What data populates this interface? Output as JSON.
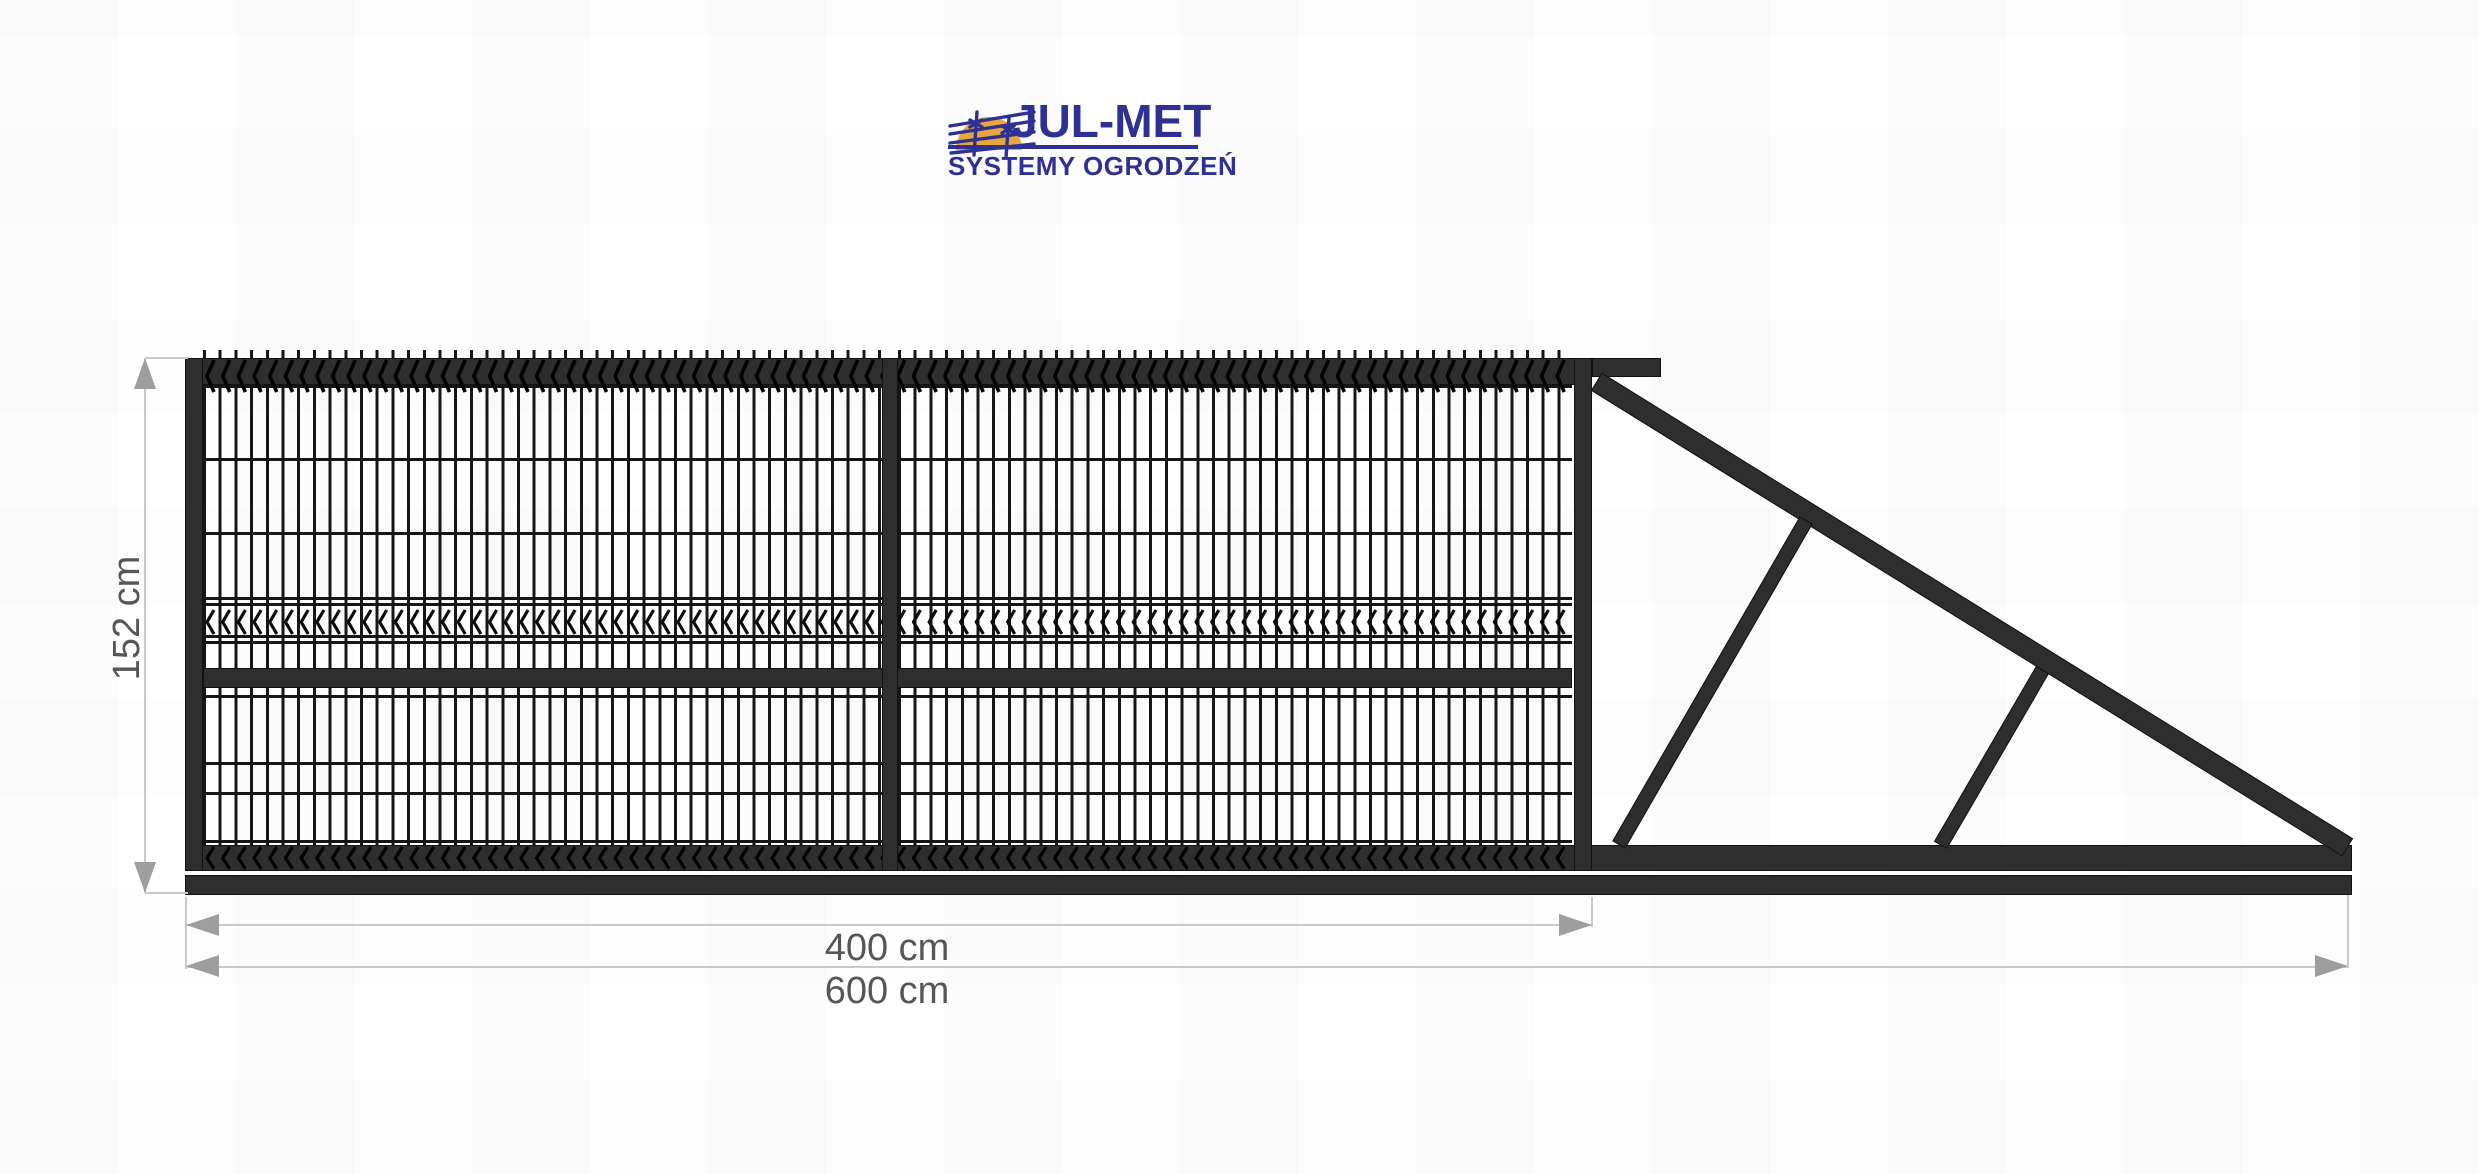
{
  "logo": {
    "brand": "JUL-MET",
    "tagline": "SYSTEMY OGRODZEŃ",
    "brand_color": "#2e3192",
    "sun_color": "#e9a63c"
  },
  "diagram": {
    "type": "sliding-gate-technical-drawing",
    "dimensions": {
      "height": "152 cm",
      "leaf_width": "400 cm",
      "total_length": "600 cm"
    },
    "style": {
      "frame_color": "#2e2e2e",
      "mesh_wire_color": "#161616",
      "dimension_line_color": "#c9c9c9",
      "dimension_arrow_color": "#9e9e9e",
      "dimension_text_color": "#565656",
      "background": "#ffffff"
    }
  }
}
